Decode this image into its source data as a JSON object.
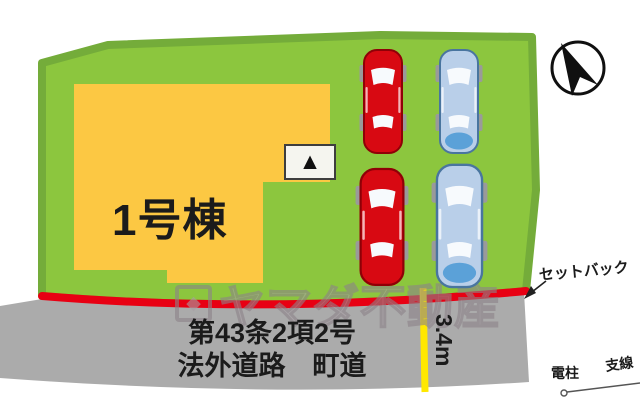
{
  "plan": {
    "building_label": "1号棟",
    "road": {
      "line1": "第43条2項2号",
      "line2": "法外道路　町道",
      "width_label": "3.4m"
    },
    "annotations": {
      "setback": "セットバック",
      "utility_pole": "電柱",
      "guy_wire": "支線"
    },
    "parking": {
      "cars": [
        {
          "row": 1,
          "column": 1,
          "color": "red"
        },
        {
          "row": 1,
          "column": 2,
          "color": "blue"
        },
        {
          "row": 2,
          "column": 1,
          "color": "red"
        },
        {
          "row": 2,
          "column": 2,
          "color": "blue"
        }
      ]
    }
  },
  "watermark": {
    "text": "ヤマダ不動産",
    "logo_icon": "◆"
  },
  "icons": {
    "north_arrow": "compass-needle-in-circle",
    "entrance_direction": "▲",
    "utility_pole": "circle-with-guy-wire"
  },
  "colors": {
    "plot_green": "#8cc63e",
    "plot_border_green": "#74ac3a",
    "building_yellow": "#fcc843",
    "road_gray": "#ababab",
    "setback_red": "#e80013",
    "width_line_yellow": "#ffe800",
    "car_red": "#d80912",
    "car_red_outline": "#8f0007",
    "car_blue": "#b9cfe9",
    "car_blue_outline": "#49759f",
    "car_blue_hood": "#5ba1d8",
    "wheel_gray": "#9a9a9a",
    "window_white": "#f7fafd",
    "compass_black": "#101010",
    "text_black": "#1b1b1b",
    "watermark_gray": "#a89fa5"
  }
}
